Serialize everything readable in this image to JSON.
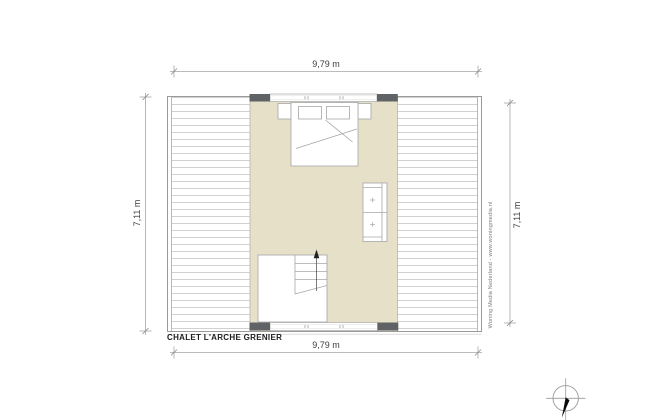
{
  "title": "CHALET L'ARCHE GRENIER",
  "dimensions": {
    "top": "9,79 m",
    "bottom": "9,79 m",
    "left": "7,11 m",
    "right": "7,11 m"
  },
  "watermark": "Woning Media Nederland - www.woningmedia.nl",
  "colors": {
    "room_fill": "#e6e0c9",
    "wall_fill": "#5f6365",
    "outline": "#9b9b9b",
    "hatch_line": "#cccccc",
    "furniture_line": "#a6a6a6",
    "dimension_line": "#a5a5a5",
    "needle": "#0a0a0a"
  },
  "symbols": {
    "north_indicator": "compass-north-arrow",
    "stair_direction": "up-arrow",
    "furniture": [
      "double-bed",
      "nightstand-left",
      "nightstand-right",
      "two-seat-sofa",
      "staircase"
    ],
    "construction": [
      "window-band-top",
      "window-band-bottom",
      "wall-segments",
      "sloped-roof-floor-hatch"
    ]
  }
}
